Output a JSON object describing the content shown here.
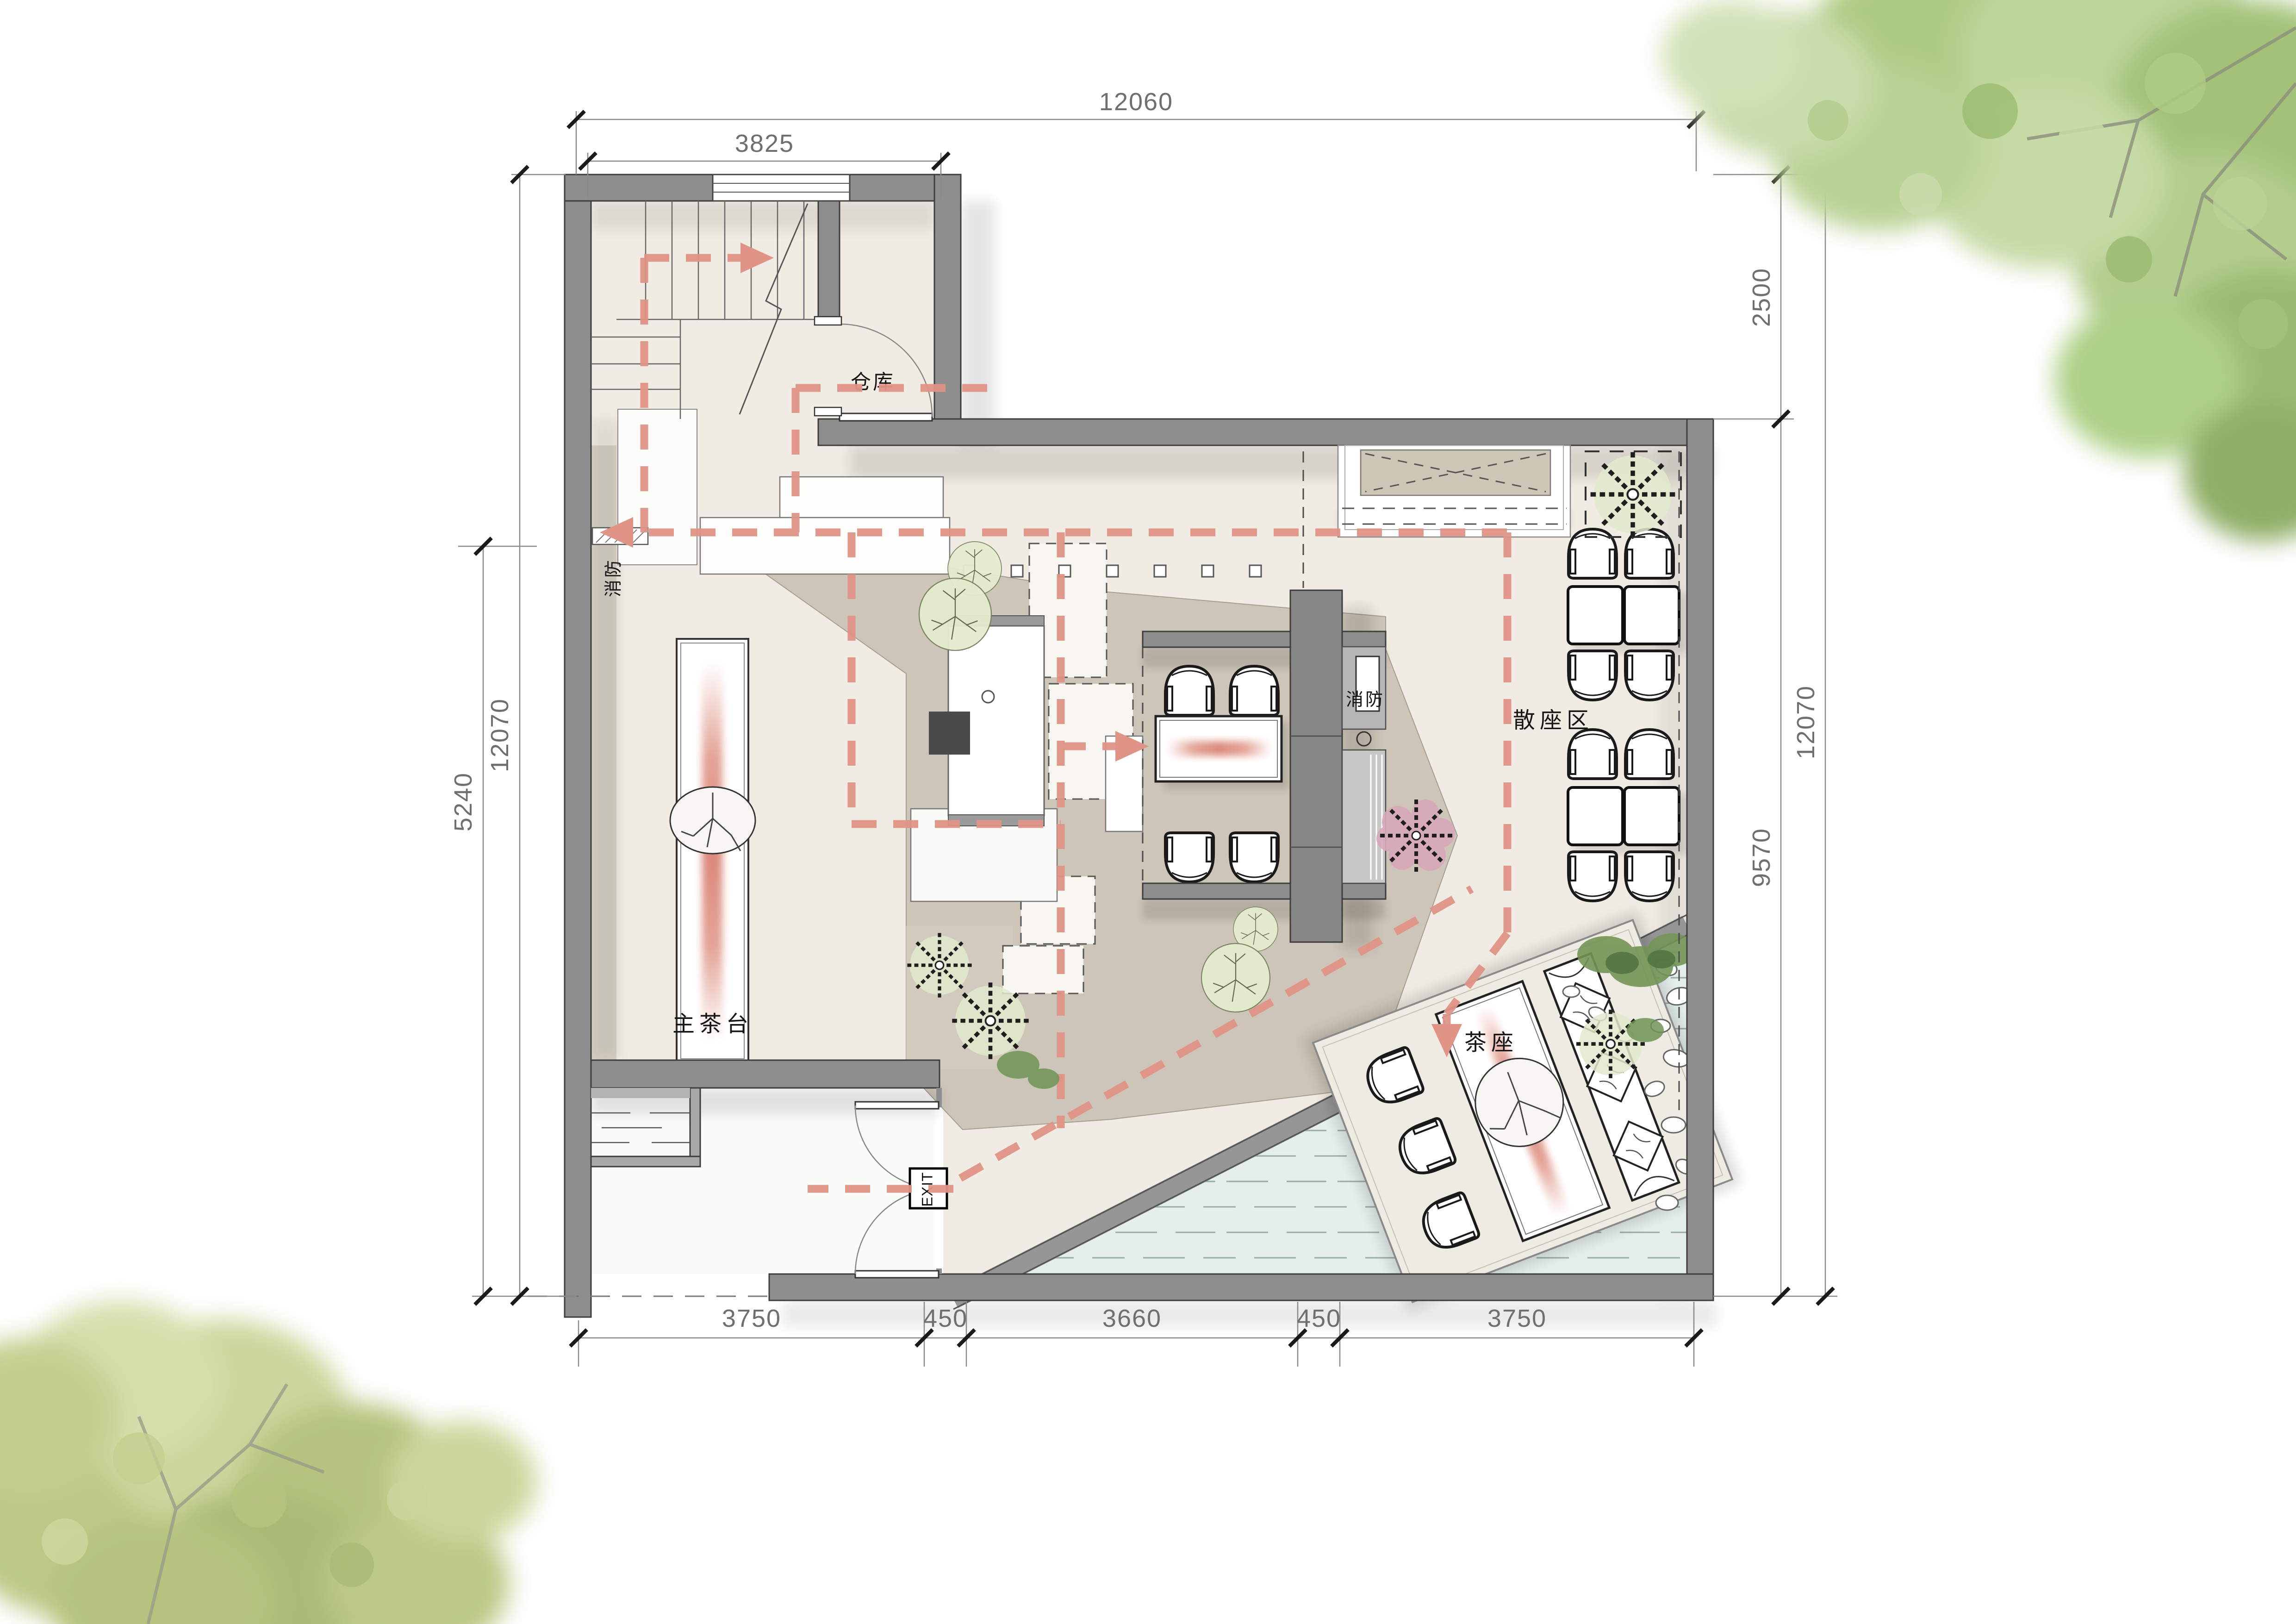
{
  "plan": {
    "title": "tea-house floor plan",
    "labels": {
      "storage": "仓库",
      "fire_wall": "消防",
      "fire_cabinet": "消防",
      "open_seating": "散座区",
      "main_tea_counter": "主茶台",
      "tea_seating": "茶座",
      "exit": "EXIT"
    },
    "dimensions": {
      "top_total": "12060",
      "top_left": "3825",
      "left_outer": "12070",
      "left_inner": "5240",
      "right_upper": "2500",
      "right_lower": "9570",
      "right_outer": "12070",
      "bottom": [
        "3750",
        "450",
        "3660",
        "450",
        "3750"
      ]
    },
    "colors": {
      "wall": "#8e8e8e",
      "wall_edge": "#3d3d3d",
      "floor": "#f0ece3",
      "floor_dark": "#cdc5b7",
      "water": "#e4efec",
      "circulation": "#df9486",
      "foliage": "#aecb83",
      "dimension": "#6f6f6f"
    }
  }
}
